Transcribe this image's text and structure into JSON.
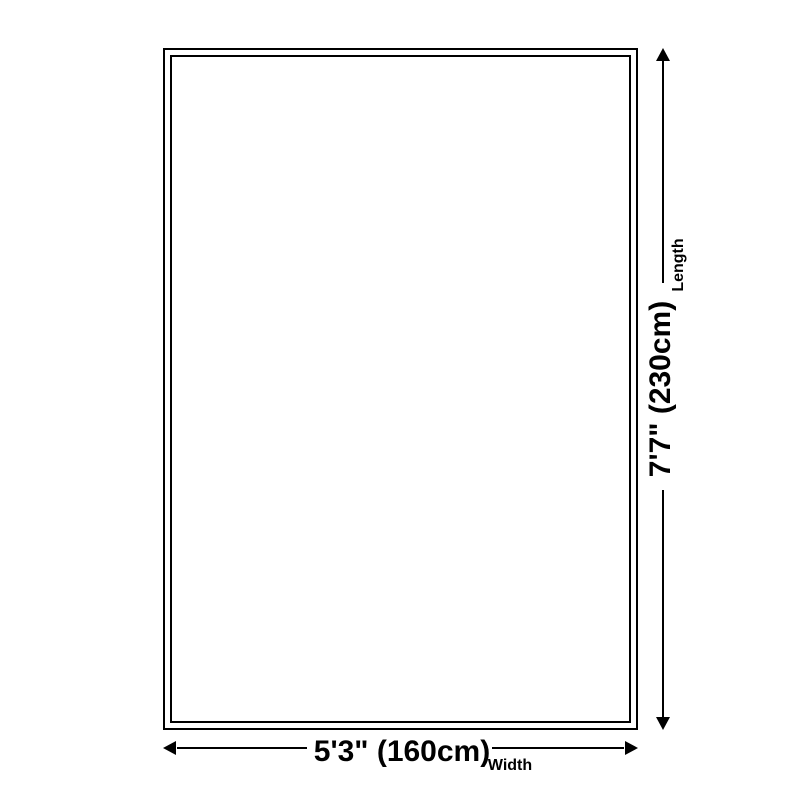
{
  "diagram": {
    "type": "product-size-diagram",
    "shape": "rectangle",
    "colors": {
      "line": "#000000",
      "background": "#ffffff"
    },
    "length": {
      "value": "7'7\" (230cm)",
      "label": "Length"
    },
    "width": {
      "value": "5'3\" (160cm)",
      "label": "Width"
    }
  }
}
